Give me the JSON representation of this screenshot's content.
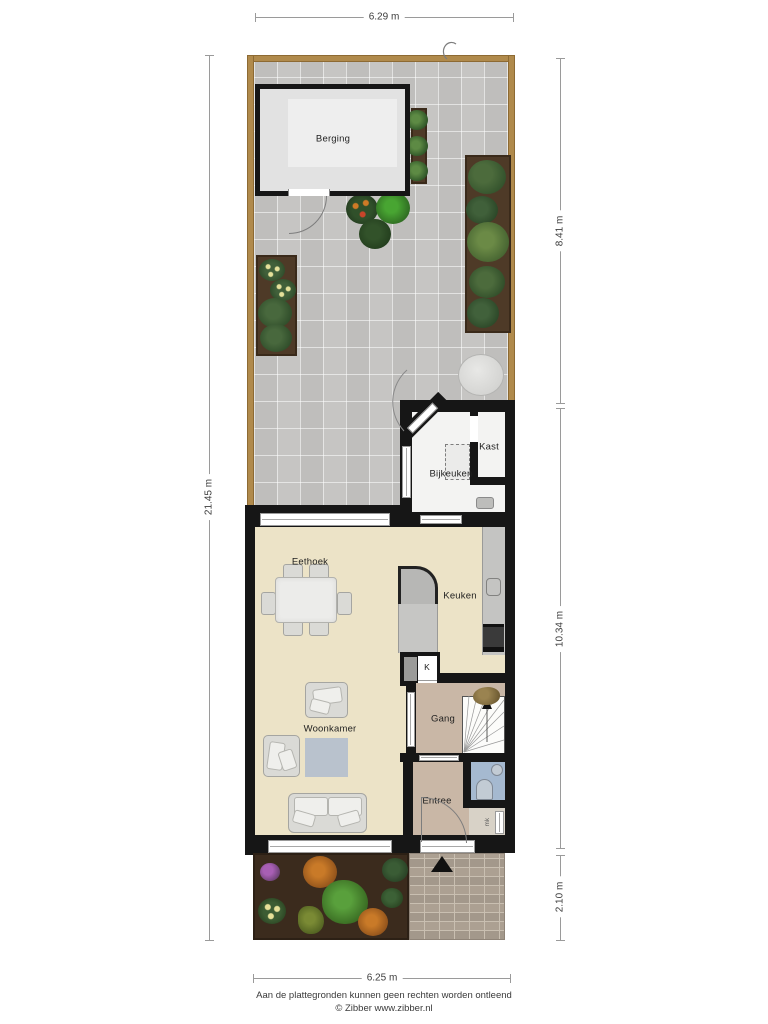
{
  "dimensions": {
    "width_top": "6.29 m",
    "height_left": "21.45 m",
    "garden_height": "8.41 m",
    "house_height": "10.34 m",
    "front_height": "2.10 m",
    "width_bottom": "6.25 m"
  },
  "rooms": {
    "berging": "Berging",
    "kast": "Kast",
    "bijkeuken": "Bijkeuken",
    "eethoek": "Eethoek",
    "keuken": "Keuken",
    "kast_small": "K",
    "gang": "Gang",
    "woonkamer": "Woonkamer",
    "entree": "Entree",
    "meterkast": "mk"
  },
  "footer": {
    "disclaimer": "Aan de plattegronden kunnen geen rechten worden ontleend",
    "credit": "© Zibber www.zibber.nl"
  },
  "colors": {
    "wall": "#161616",
    "fence": "#b08a4c",
    "paving": "#c6c5c3",
    "floor_main": "#ece3c7",
    "floor_hall": "#c9b7a6",
    "floor_wc": "#a5b9d0",
    "soil": "#4e3a27"
  }
}
